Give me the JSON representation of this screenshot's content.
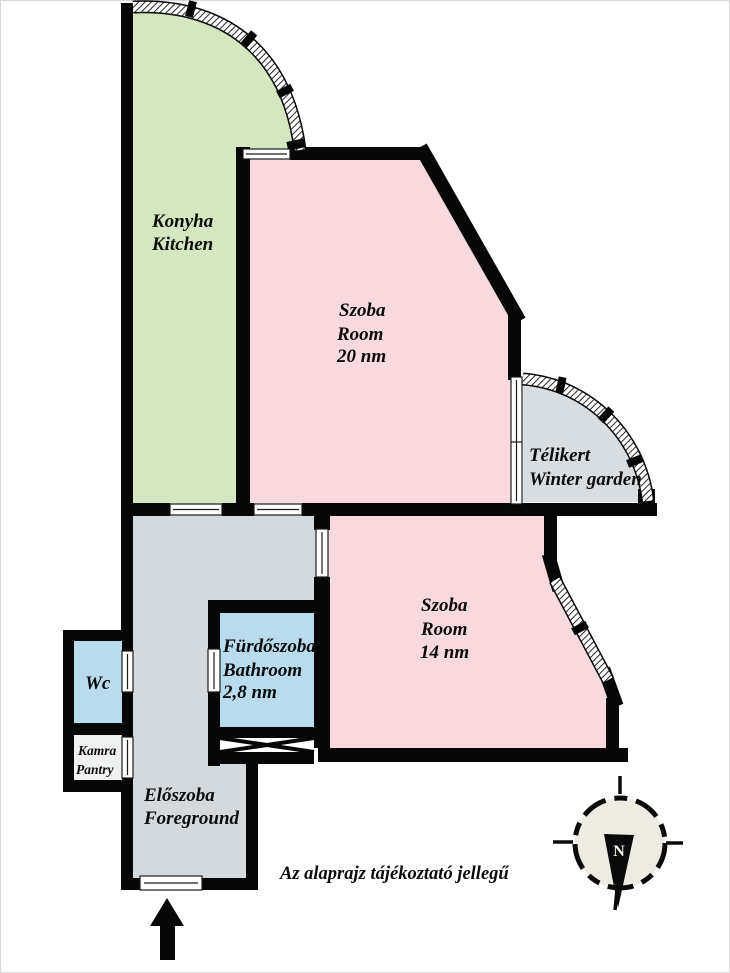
{
  "note": "Az alaprajz tájékoztató jellegű",
  "compass": {
    "north_label": "N"
  },
  "rooms": {
    "kitchen": {
      "name_hu": "Konyha",
      "name_en": "Kitchen"
    },
    "room20": {
      "name_hu": "Szoba",
      "name_en": "Room",
      "area": "20 nm"
    },
    "winter_garden": {
      "name_hu": "Télikert",
      "name_en": "Winter garden"
    },
    "room14": {
      "name_hu": "Szoba",
      "name_en": "Room",
      "area": "14 nm"
    },
    "bathroom": {
      "name_hu": "Fürdőszoba",
      "name_en": "Bathroom",
      "area": "2,8 nm"
    },
    "wc": {
      "name": "Wc"
    },
    "pantry": {
      "name_hu": "Kamra",
      "name_en": "Pantry"
    },
    "hall": {
      "name_hu": "Előszoba",
      "name_en": "Foreground"
    }
  },
  "colors": {
    "kitchen": "#d5e7c1",
    "room": "#f8d9de",
    "winter_garden": "#d8dde2",
    "hall": "#d4d9dd",
    "wet": "#b9dcec",
    "pantry": "#eff1f1",
    "wall": "#070707",
    "compass_fill": "#edebe2"
  }
}
